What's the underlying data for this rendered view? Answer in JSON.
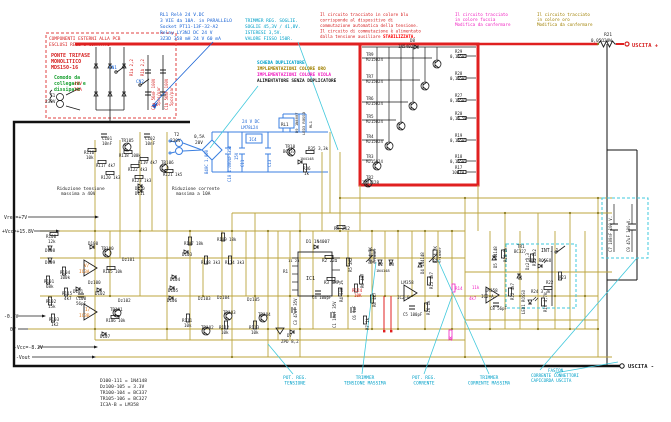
{
  "annotations": {
    "relay_note": [
      "RL1 Relè 24 V.DC",
      "3 VIE da 10A. in PARALLELO",
      "Socket PT11-13F-32-A2",
      "Relay LY3NJ DC 24 V",
      "3Z3D 358 mH 24 V 60 mA"
    ],
    "trimmer_note": [
      "TRIMMER REG. SOGLIE.",
      "SOGLIE 45,3V / 41,8V.",
      "ISTERESI 3,5V.",
      "VALORE FISSO 150R."
    ],
    "circuit_note": [
      "Il circuito tracciato in colore blu",
      "corrisponde al dispositivo di",
      "commutazione automatica della tensione.",
      "Il circuito di commutazione è alimentato",
      "dalla tensione ausiliare"
    ],
    "circuit_note_hl": "STABILIZZATA.",
    "fucsia_note": [
      "Il circuito tracciato",
      "in colore fucsia",
      "Modifica da confermare"
    ],
    "oro_note": [
      "Il circuito tracciato",
      "in colore oro",
      "Modifica da confermare"
    ]
  },
  "left_box": {
    "title1": "COMPONENTI ESTERNI ALLA PCB",
    "title2": "ESCLUSI RELE e CONTATTI",
    "bridge": [
      "PONTE TRIFASE",
      "MONOLITICO",
      "MDS150-16"
    ],
    "note": [
      "Comodo da",
      "collegare e",
      "dissipare"
    ]
  },
  "duplicator": {
    "l1": "SCHEDA DUPLICATORE",
    "l2": "IMPLEMENTAZIONI COLORE ORO",
    "l3": "IMPLEMENTAZIONI COLORE VIOLA",
    "l4": "ALIMENTATORE SENZA DUPLICATORE"
  },
  "legend": {
    "lines": [
      "D100-111  = 1N4148",
      "Dz100-105 = 3.3V",
      "TR100-104 = BC337",
      "TR105-106 = BC327",
      "IC3A-B    = LM358"
    ]
  },
  "bottom": {
    "pot_tensione": [
      "POT. REG.",
      "TENSIONE"
    ],
    "trim_tensione": [
      "TRIMMER",
      "TENSIONE MASSIMA"
    ],
    "pot_corrente": [
      "POT. REG.",
      "CORRENTE"
    ],
    "trim_corrente": [
      "TRIMMER",
      "CORRENTE MASSIMA"
    ],
    "faston": [
      "FASTON",
      "CORRENTE CONNETTORI",
      "CAPICORDA USCITA"
    ]
  },
  "labels": [
    {
      "n": "t1-label",
      "t": "T1",
      "x": 50,
      "y": 97
    },
    {
      "t": "230V",
      "x": 45,
      "y": 103
    },
    {
      "t": "40V",
      "x": 74,
      "y": 85,
      "c": "#d62020"
    },
    {
      "t": "25A",
      "x": 74,
      "y": 91,
      "c": "#d62020"
    },
    {
      "n": "cn1-label",
      "t": "CN1",
      "x": 109,
      "y": 69,
      "c": "#1560d4"
    },
    {
      "n": "cn2-label",
      "t": "CN2",
      "x": 136,
      "y": 83,
      "c": "#1560d4"
    },
    {
      "t": "R1a 2,2",
      "x": 133,
      "y": 76,
      "r": -90,
      "c": "#d62020",
      "s": 4
    },
    {
      "t": "R1b 2,2",
      "x": 144,
      "y": 76,
      "r": -90,
      "c": "#d62020",
      "s": 4
    },
    {
      "t": "C1a 56mF 100V",
      "x": 155,
      "y": 110,
      "r": -90,
      "c": "#d62020",
      "s": 4
    },
    {
      "t": "5pcs/par",
      "x": 160,
      "y": 106,
      "r": -90,
      "c": "#d62020",
      "s": 4
    },
    {
      "t": "C1b 56mF 100V",
      "x": 168,
      "y": 110,
      "r": -90,
      "c": "#d62020",
      "s": 4
    },
    {
      "t": "5pcs/par",
      "x": 173,
      "y": 106,
      "r": -90,
      "c": "#d62020",
      "s": 4
    },
    {
      "n": "t2-label",
      "t": "T2",
      "x": 174,
      "y": 136
    },
    {
      "t": "230V",
      "x": 170,
      "y": 142
    },
    {
      "t": "0,5A",
      "x": 194,
      "y": 138
    },
    {
      "t": "20V",
      "x": 195,
      "y": 144
    },
    {
      "t": "B40C 1.000",
      "x": 208,
      "y": 174,
      "r": -90,
      "c": "#1560d4",
      "s": 4
    },
    {
      "t": "C10 1.000uF 35V",
      "x": 231,
      "y": 182,
      "r": -90,
      "c": "#1560d4",
      "s": 4
    },
    {
      "t": "24 V DC",
      "x": 242,
      "y": 123,
      "c": "#1560d4",
      "s": 4.2
    },
    {
      "t": "LM78L24",
      "x": 241,
      "y": 129,
      "c": "#1560d4",
      "s": 4
    },
    {
      "t": "IC4",
      "x": 249,
      "y": 141,
      "c": "#1560d4",
      "s": 4.2
    },
    {
      "t": "15V",
      "x": 238,
      "y": 160,
      "r": -90,
      "c": "#1560d4",
      "s": 4
    },
    {
      "t": "C11",
      "x": 244,
      "y": 167,
      "r": -90,
      "c": "#1560d4",
      "s": 4
    },
    {
      "t": "C13",
      "x": 271,
      "y": 167,
      "r": -90,
      "c": "#1560d4",
      "s": 4
    },
    {
      "t": "RL1",
      "x": 281,
      "y": 126,
      "s": 4.2
    },
    {
      "t": "D9 1N4007",
      "x": 298,
      "y": 133,
      "r": -90,
      "s": 3.8
    },
    {
      "t": "LED3 ROSSO",
      "x": 305,
      "y": 135,
      "r": -90,
      "s": 3.8
    },
    {
      "t": "RL1",
      "x": 312,
      "y": 128,
      "r": -90,
      "s": 3.8
    },
    {
      "t": "TR10",
      "x": 285,
      "y": 148,
      "s": 4.2
    },
    {
      "t": "BC337",
      "x": 283,
      "y": 153,
      "s": 4
    },
    {
      "t": "R35 3,3k",
      "x": 308,
      "y": 150,
      "s": 4.2
    },
    {
      "t": "1N4148",
      "x": 300,
      "y": 160,
      "s": 3.8
    },
    {
      "t": "R36",
      "x": 303,
      "y": 170,
      "s": 4.2
    },
    {
      "t": "1k",
      "x": 304,
      "y": 175,
      "s": 4.2
    },
    {
      "t": "D8",
      "x": 410,
      "y": 42,
      "s": 4.2
    },
    {
      "t": "1N5402",
      "x": 398,
      "y": 48,
      "s": 4.2
    },
    {
      "t": "TR9",
      "x": 366,
      "y": 56,
      "s": 4.2
    },
    {
      "t": "MJ15024",
      "x": 366,
      "y": 61,
      "s": 4
    },
    {
      "t": "TR7",
      "x": 366,
      "y": 78,
      "s": 4.2
    },
    {
      "t": "MJ15024",
      "x": 366,
      "y": 83,
      "s": 4
    },
    {
      "t": "TR6",
      "x": 366,
      "y": 100,
      "s": 4.2
    },
    {
      "t": "MJ15024",
      "x": 366,
      "y": 105,
      "s": 4
    },
    {
      "t": "TR5",
      "x": 366,
      "y": 118,
      "s": 4.2
    },
    {
      "t": "MJ15024",
      "x": 366,
      "y": 123,
      "s": 4
    },
    {
      "t": "TR4",
      "x": 366,
      "y": 138,
      "s": 4.2
    },
    {
      "t": "MJ15024",
      "x": 366,
      "y": 143,
      "s": 4
    },
    {
      "t": "TR3",
      "x": 366,
      "y": 158,
      "s": 4.2
    },
    {
      "t": "MJ15024",
      "x": 366,
      "y": 163,
      "s": 4
    },
    {
      "t": "R29",
      "x": 455,
      "y": 53,
      "s": 4
    },
    {
      "t": "0,1Ω5W",
      "x": 450,
      "y": 58,
      "s": 4
    },
    {
      "t": "R28",
      "x": 455,
      "y": 75,
      "s": 4
    },
    {
      "t": "0,1Ω5W",
      "x": 450,
      "y": 80,
      "s": 4
    },
    {
      "t": "R27",
      "x": 455,
      "y": 97,
      "s": 4
    },
    {
      "t": "0,1Ω5W",
      "x": 450,
      "y": 102,
      "s": 4
    },
    {
      "t": "R20",
      "x": 455,
      "y": 115,
      "s": 4
    },
    {
      "t": "0,1Ω 5W",
      "x": 450,
      "y": 120,
      "s": 4
    },
    {
      "t": "R19",
      "x": 455,
      "y": 137,
      "s": 4
    },
    {
      "t": "0,1Ω5W",
      "x": 450,
      "y": 142,
      "s": 4
    },
    {
      "t": "R18",
      "x": 455,
      "y": 158,
      "s": 4
    },
    {
      "t": "0,1Ω5W",
      "x": 450,
      "y": 163,
      "s": 4
    },
    {
      "t": "R17",
      "x": 455,
      "y": 169,
      "s": 4
    },
    {
      "t": "10Ω1W",
      "x": 452,
      "y": 174,
      "s": 4
    },
    {
      "t": "TR2",
      "x": 366,
      "y": 179,
      "s": 4.2
    },
    {
      "t": "2SD1128",
      "x": 362,
      "y": 184,
      "s": 4
    },
    {
      "n": "r21-label",
      "t": "R21",
      "x": 612,
      "y": 36,
      "a": "end",
      "s": 4.4
    },
    {
      "n": "r21-value",
      "t": "0,05Ω20W",
      "x": 612,
      "y": 42,
      "a": "end",
      "s": 4.4
    },
    {
      "n": "uscita-plus",
      "t": "USCITA +",
      "x": 632,
      "y": 47,
      "c": "#d62020",
      "b": 1,
      "s": 5.4
    },
    {
      "n": "uscita-minus",
      "t": "USCITA -",
      "x": 628,
      "y": 368,
      "b": 1,
      "s": 5.4
    },
    {
      "t": "C7 100nF 100 V.",
      "x": 612,
      "y": 252,
      "r": -90,
      "s": 4
    },
    {
      "t": "C9 47uF 100 V.",
      "x": 630,
      "y": 252,
      "r": -90,
      "s": 4
    },
    {
      "t": "R9 2K2",
      "x": 334,
      "y": 230,
      "s": 4.4
    },
    {
      "t": "D1 1N4007",
      "x": 306,
      "y": 243,
      "s": 4.4
    },
    {
      "t": "11 23",
      "x": 288,
      "y": 262,
      "s": 3.8
    },
    {
      "t": "IC1",
      "x": 306,
      "y": 280,
      "s": 5
    },
    {
      "t": "R1",
      "x": 283,
      "y": 273,
      "s": 4.2
    },
    {
      "t": "R2 22Ω",
      "x": 322,
      "y": 262,
      "s": 4.2
    },
    {
      "t": "R3 6K7",
      "x": 324,
      "y": 284,
      "s": 4.2
    },
    {
      "t": "R4 50K 1%",
      "x": 343,
      "y": 302,
      "r": -90,
      "s": 4
    },
    {
      "t": "R5 2K2",
      "x": 352,
      "y": 272,
      "r": -90,
      "s": 4
    },
    {
      "t": "P1 4,7K",
      "x": 372,
      "y": 264,
      "r": -90,
      "s": 4
    },
    {
      "t": "trimmer",
      "x": 376,
      "y": 264,
      "r": -90,
      "s": 3.8
    },
    {
      "t": "R6 4k7",
      "x": 364,
      "y": 288,
      "r": -90,
      "s": 4
    },
    {
      "t": "R124",
      "x": 352,
      "y": 292,
      "c": "#d62020",
      "s": 4.2
    },
    {
      "t": "10K",
      "x": 354,
      "y": 297,
      "c": "#d62020",
      "s": 4.2
    },
    {
      "t": "D2",
      "x": 378,
      "y": 266,
      "s": 4.2
    },
    {
      "t": "D3",
      "x": 389,
      "y": 266,
      "s": 4.2
    },
    {
      "t": "1N4148",
      "x": 376,
      "y": 272,
      "s": 3.8
    },
    {
      "t": "C6 1uF",
      "x": 356,
      "y": 320,
      "r": -90,
      "s": 4
    },
    {
      "t": "C1 10uF 35V",
      "x": 336,
      "y": 328,
      "r": -90,
      "s": 4
    },
    {
      "t": "C3 47uF 35V",
      "x": 297,
      "y": 325,
      "r": -90,
      "s": 4
    },
    {
      "t": "C4 100pF",
      "x": 312,
      "y": 299,
      "s": 4
    },
    {
      "t": "R7 1k",
      "x": 369,
      "y": 330,
      "r": -90,
      "s": 4
    },
    {
      "t": "R8 4k7",
      "x": 376,
      "y": 307,
      "r": -90,
      "s": 4
    },
    {
      "t": "D7",
      "x": 287,
      "y": 337,
      "s": 4.2
    },
    {
      "t": "ZPD 8,2",
      "x": 281,
      "y": 343,
      "s": 4.2
    },
    {
      "t": "D4 1N4148",
      "x": 424,
      "y": 274,
      "r": -90,
      "s": 4
    },
    {
      "t": "R15 4k7",
      "x": 433,
      "y": 289,
      "r": -90,
      "s": 4
    },
    {
      "t": "P2 4,7K",
      "x": 437,
      "y": 263,
      "r": -90,
      "s": 4
    },
    {
      "t": "trimmer",
      "x": 441,
      "y": 263,
      "r": -90,
      "s": 3.8
    },
    {
      "t": "LM358",
      "x": 401,
      "y": 284,
      "s": 4.2
    },
    {
      "t": "IC2-B",
      "x": 397,
      "y": 299,
      "s": 4.2
    },
    {
      "t": "C5 100pF",
      "x": 403,
      "y": 316,
      "s": 4
    },
    {
      "t": "R16 1k",
      "x": 430,
      "y": 315,
      "r": -90,
      "s": 4
    },
    {
      "t": "R14",
      "x": 455,
      "y": 290,
      "c": "#f020c0",
      "s": 4.2
    },
    {
      "t": "11k",
      "x": 472,
      "y": 289,
      "c": "#f020c0",
      "s": 4
    },
    {
      "t": "4k7",
      "x": 469,
      "y": 300,
      "c": "#f020c0",
      "s": 4
    },
    {
      "t": "2k",
      "x": 452,
      "y": 341,
      "r": -90,
      "c": "#f020c0",
      "s": 4
    },
    {
      "t": "C101",
      "x": 102,
      "y": 140,
      "s": 4.2
    },
    {
      "t": "10nF",
      "x": 102,
      "y": 145,
      "s": 4.2
    },
    {
      "t": "TR105",
      "x": 121,
      "y": 142,
      "s": 4.2
    },
    {
      "t": "C102",
      "x": 145,
      "y": 140,
      "s": 4.2
    },
    {
      "t": "10nF",
      "x": 145,
      "y": 145,
      "s": 4.2
    },
    {
      "t": "R116",
      "x": 84,
      "y": 154,
      "s": 4.2
    },
    {
      "t": "10k",
      "x": 86,
      "y": 159,
      "s": 4.2
    },
    {
      "t": "R118 100k",
      "x": 119,
      "y": 157,
      "s": 4
    },
    {
      "t": "R117 4k7",
      "x": 96,
      "y": 167,
      "s": 4
    },
    {
      "t": "R119 4k7",
      "x": 138,
      "y": 164,
      "s": 4
    },
    {
      "t": "TR106",
      "x": 161,
      "y": 164,
      "s": 4.2
    },
    {
      "t": "R120 1k3",
      "x": 101,
      "y": 179,
      "s": 4
    },
    {
      "t": "R122 4k3",
      "x": 128,
      "y": 171,
      "s": 4
    },
    {
      "t": "R123 1k3",
      "x": 132,
      "y": 182,
      "s": 4
    },
    {
      "t": "R121 1k5",
      "x": 163,
      "y": 176,
      "s": 4
    },
    {
      "t": "D110",
      "x": 135,
      "y": 190,
      "s": 4
    },
    {
      "t": "D111",
      "x": 135,
      "y": 195,
      "s": 4
    },
    {
      "t": "Riduzione tensione",
      "x": 57,
      "y": 190,
      "s": 4.4
    },
    {
      "t": "massima a 40V",
      "x": 61,
      "y": 195,
      "s": 4.4
    },
    {
      "t": "Riduzione corrente",
      "x": 172,
      "y": 190,
      "s": 4.4
    },
    {
      "t": "massima a 10A",
      "x": 176,
      "y": 195,
      "s": 4.4
    },
    {
      "n": "rail-vref",
      "t": "Vref=+7V",
      "x": 4,
      "y": 219,
      "s": 4.8
    },
    {
      "n": "rail-vcc",
      "t": "+Vcc=+15.8V",
      "x": 2,
      "y": 233,
      "s": 4.8
    },
    {
      "t": "R100",
      "x": 46,
      "y": 238,
      "s": 4.2
    },
    {
      "t": "12k",
      "x": 48,
      "y": 243,
      "s": 4.2
    },
    {
      "t": "D100",
      "x": 88,
      "y": 245,
      "s": 4.2
    },
    {
      "t": "TR100",
      "x": 101,
      "y": 250,
      "s": 4.2
    },
    {
      "t": "D108",
      "x": 45,
      "y": 252,
      "s": 4.2
    },
    {
      "t": "D109",
      "x": 45,
      "y": 264,
      "s": 4.2
    },
    {
      "t": "R104",
      "x": 60,
      "y": 274,
      "s": 4.2
    },
    {
      "t": "100k",
      "x": 60,
      "y": 279,
      "s": 4.2
    },
    {
      "t": "R101",
      "x": 44,
      "y": 283,
      "s": 4.2
    },
    {
      "t": "68k",
      "x": 46,
      "y": 288,
      "s": 4.2
    },
    {
      "t": "R115",
      "x": 62,
      "y": 295,
      "s": 4.2
    },
    {
      "t": "4k7",
      "x": 64,
      "y": 300,
      "s": 4.2
    },
    {
      "t": "R102",
      "x": 46,
      "y": 303,
      "s": 4.2
    },
    {
      "t": "15k",
      "x": 48,
      "y": 308,
      "s": 4.2
    },
    {
      "t": "R103",
      "x": 49,
      "y": 321,
      "s": 4.2
    },
    {
      "t": "1k2",
      "x": 51,
      "y": 326,
      "s": 4.2
    },
    {
      "t": "V/",
      "x": 84,
      "y": 267,
      "c": "#e07818",
      "s": 4.4
    },
    {
      "t": "IC3A",
      "x": 79,
      "y": 273,
      "c": "#e07818",
      "s": 4.4
    },
    {
      "t": "I/",
      "x": 85,
      "y": 311,
      "c": "#e07818",
      "s": 4.4
    },
    {
      "t": "IC3B",
      "x": 79,
      "y": 317,
      "c": "#e07818",
      "s": 4.4
    },
    {
      "t": "C100",
      "x": 76,
      "y": 300,
      "s": 4.2
    },
    {
      "t": "56pF",
      "x": 76,
      "y": 305,
      "s": 4.2
    },
    {
      "t": "Dz100",
      "x": 88,
      "y": 284,
      "s": 4.2
    },
    {
      "t": "D101",
      "x": 73,
      "y": 293,
      "s": 4.2
    },
    {
      "t": "D102",
      "x": 95,
      "y": 295,
      "s": 4.2
    },
    {
      "t": "Dz101",
      "x": 122,
      "y": 261,
      "s": 4.2
    },
    {
      "t": "R105 10k",
      "x": 103,
      "y": 273,
      "s": 4
    },
    {
      "t": "Dz102",
      "x": 118,
      "y": 302,
      "s": 4.2
    },
    {
      "t": "TR101",
      "x": 110,
      "y": 311,
      "s": 4.2
    },
    {
      "t": "R106 10k",
      "x": 106,
      "y": 322,
      "s": 4
    },
    {
      "t": "D107",
      "x": 100,
      "y": 338,
      "s": 4.2
    },
    {
      "t": "R107 18k",
      "x": 184,
      "y": 245,
      "s": 4
    },
    {
      "t": "R109 18k",
      "x": 217,
      "y": 241,
      "s": 4
    },
    {
      "t": "D103",
      "x": 182,
      "y": 256,
      "s": 4.2
    },
    {
      "t": "R108 3k3",
      "x": 201,
      "y": 264,
      "s": 4
    },
    {
      "t": "R114 3k3",
      "x": 225,
      "y": 264,
      "s": 4
    },
    {
      "t": "D104",
      "x": 170,
      "y": 281,
      "s": 4.2
    },
    {
      "t": "D105",
      "x": 168,
      "y": 292,
      "s": 4.2
    },
    {
      "t": "D106",
      "x": 167,
      "y": 302,
      "s": 4.2
    },
    {
      "t": "Dz103",
      "x": 198,
      "y": 300,
      "s": 4.2
    },
    {
      "t": "Dz104",
      "x": 217,
      "y": 299,
      "s": 4.2
    },
    {
      "t": "TR102",
      "x": 201,
      "y": 329,
      "s": 4.2
    },
    {
      "t": "TR103",
      "x": 223,
      "y": 314,
      "s": 4.2
    },
    {
      "t": "R111",
      "x": 182,
      "y": 322,
      "s": 4.2
    },
    {
      "t": "10k",
      "x": 184,
      "y": 327,
      "s": 4.2
    },
    {
      "t": "R112",
      "x": 219,
      "y": 329,
      "s": 4.2
    },
    {
      "t": "10k",
      "x": 221,
      "y": 334,
      "s": 4.2
    },
    {
      "t": "Dz105",
      "x": 247,
      "y": 301,
      "s": 4.2
    },
    {
      "t": "TR104",
      "x": 258,
      "y": 316,
      "s": 4.2
    },
    {
      "t": "R113",
      "x": 249,
      "y": 329,
      "s": 4.2
    },
    {
      "t": "10k",
      "x": 251,
      "y": 334,
      "s": 4.2
    },
    {
      "n": "rail-neg05",
      "t": "-0.5V",
      "x": 4,
      "y": 318,
      "s": 4.8
    },
    {
      "n": "rail-0v",
      "t": "0V",
      "x": 10,
      "y": 331,
      "s": 4.8
    },
    {
      "n": "rail-negvcc",
      "t": "-Vcc=-8.2V",
      "x": 14,
      "y": 349,
      "s": 4.8
    },
    {
      "n": "rail-vout",
      "t": "-Vout",
      "x": 16,
      "y": 359,
      "s": 4.8
    },
    {
      "t": "D5 1N4148",
      "x": 497,
      "y": 268,
      "r": -90,
      "s": 4
    },
    {
      "t": "R10 1k",
      "x": 507,
      "y": 262,
      "r": -90,
      "s": 4
    },
    {
      "t": "TR1",
      "x": 517,
      "y": 248,
      "s": 4.2
    },
    {
      "t": "BC327",
      "x": 514,
      "y": 253,
      "s": 4
    },
    {
      "t": "Dz2 3,3",
      "x": 529,
      "y": 270,
      "r": -90,
      "s": 4
    },
    {
      "t": "R11 1k2",
      "x": 536,
      "y": 266,
      "r": -90,
      "s": 4
    },
    {
      "t": "R12 4k7",
      "x": 514,
      "y": 300,
      "r": -90,
      "s": 4
    },
    {
      "t": "D6",
      "x": 522,
      "y": 280,
      "r": -90,
      "s": 4
    },
    {
      "n": "int1-label",
      "t": "INT. 1",
      "x": 541,
      "y": 252,
      "s": 4.8
    },
    {
      "t": "LED2 ROSSO",
      "x": 526,
      "y": 262,
      "s": 4.2
    },
    {
      "t": "R23",
      "x": 559,
      "y": 279,
      "s": 4
    },
    {
      "t": "R22",
      "x": 546,
      "y": 284,
      "s": 4
    },
    {
      "t": "R24 3,3k",
      "x": 531,
      "y": 293,
      "s": 4
    },
    {
      "t": "R16 4,7k",
      "x": 547,
      "y": 312,
      "r": -90,
      "s": 4
    },
    {
      "t": "LED1 ROSSO",
      "x": 525,
      "y": 314,
      "r": -90,
      "s": 4
    },
    {
      "t": "LM358",
      "x": 485,
      "y": 292,
      "s": 4.2
    },
    {
      "t": "IC2-A",
      "x": 481,
      "y": 298,
      "s": 4.2
    },
    {
      "t": "C8 56pF",
      "x": 490,
      "y": 310,
      "s": 4
    }
  ]
}
